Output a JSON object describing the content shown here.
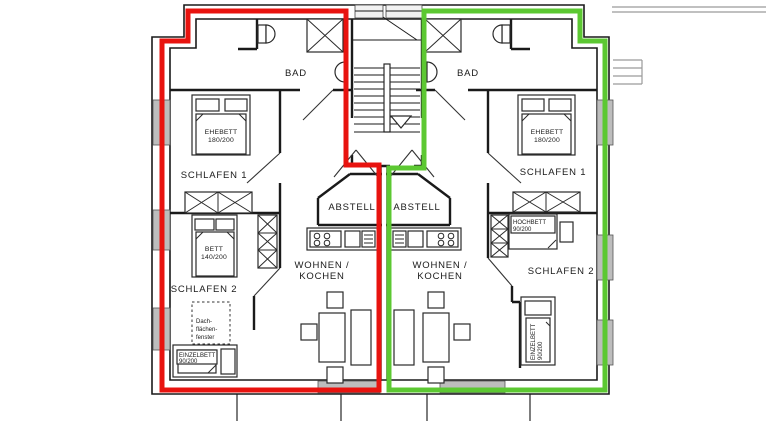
{
  "plan": {
    "colors": {
      "left_outline": "#e8130f",
      "right_outline": "#5cc832"
    },
    "left": {
      "bad": "BAD",
      "schlafen1": "SCHLAFEN 1",
      "schlafen2": "SCHLAFEN 2",
      "abstell": "ABSTELL",
      "wohnen1": "WOHNEN /",
      "wohnen2": "KOCHEN",
      "ehebett1": "EHEBETT",
      "ehebett2": "180/200",
      "bett1": "BETT",
      "bett2": "140/200",
      "einzelbett1": "EINZELBETT",
      "einzelbett2": "90/200",
      "dach1": "Dach-",
      "dach2": "flächen-",
      "dach3": "fenster"
    },
    "right": {
      "bad": "BAD",
      "schlafen1": "SCHLAFEN 1",
      "schlafen2": "SCHLAFEN 2",
      "abstell": "ABSTELL",
      "wohnen1": "WOHNEN /",
      "wohnen2": "KOCHEN",
      "ehebett1": "EHEBETT",
      "ehebett2": "180/200",
      "hochbett1": "HOCHBETT",
      "hochbett2": "90/200",
      "einzelbett1": "EINZELBETT",
      "einzelbett2": "90/200"
    }
  }
}
